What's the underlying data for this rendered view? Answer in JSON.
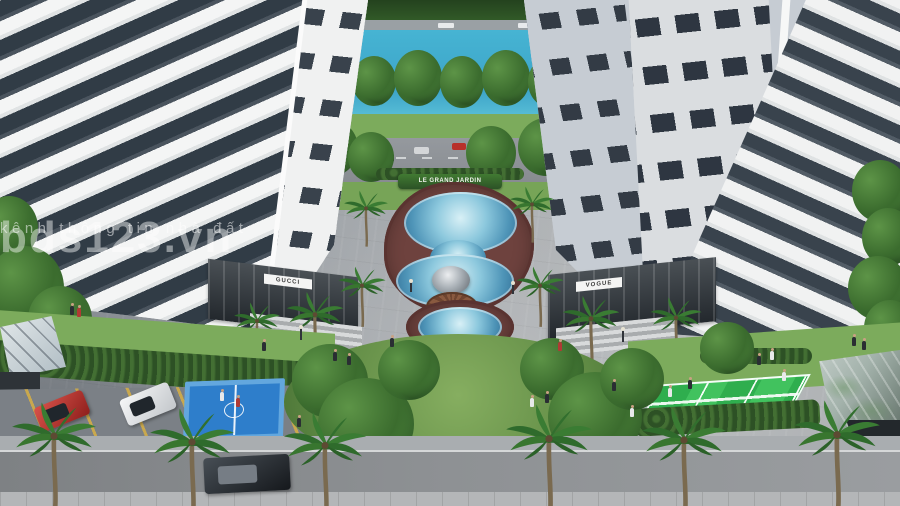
{
  "watermark": {
    "title": "bds123.vn",
    "subtitle": "kênh thông tin nhà đất"
  },
  "project_sign": {
    "label": "LE GRAND JARDIN"
  },
  "storefronts": {
    "left_sign": "GUCCI",
    "right_sign": "VOGUE"
  },
  "palette": {
    "lake_blue": "#46b4d3",
    "pool_blue": "#5fa3c6",
    "basketball_court_blue": "#2e7ecb",
    "tennis_court_green": "#2fae4e",
    "lawn_green": "#7cab5c",
    "hedge_green": "#2d5125",
    "deck_brick": "#6e423e",
    "facade_white": "#eceded",
    "facade_grey": "#c6ccd3",
    "plaza_grey": "#a8acb0",
    "watermark_white": "#ffffff"
  }
}
